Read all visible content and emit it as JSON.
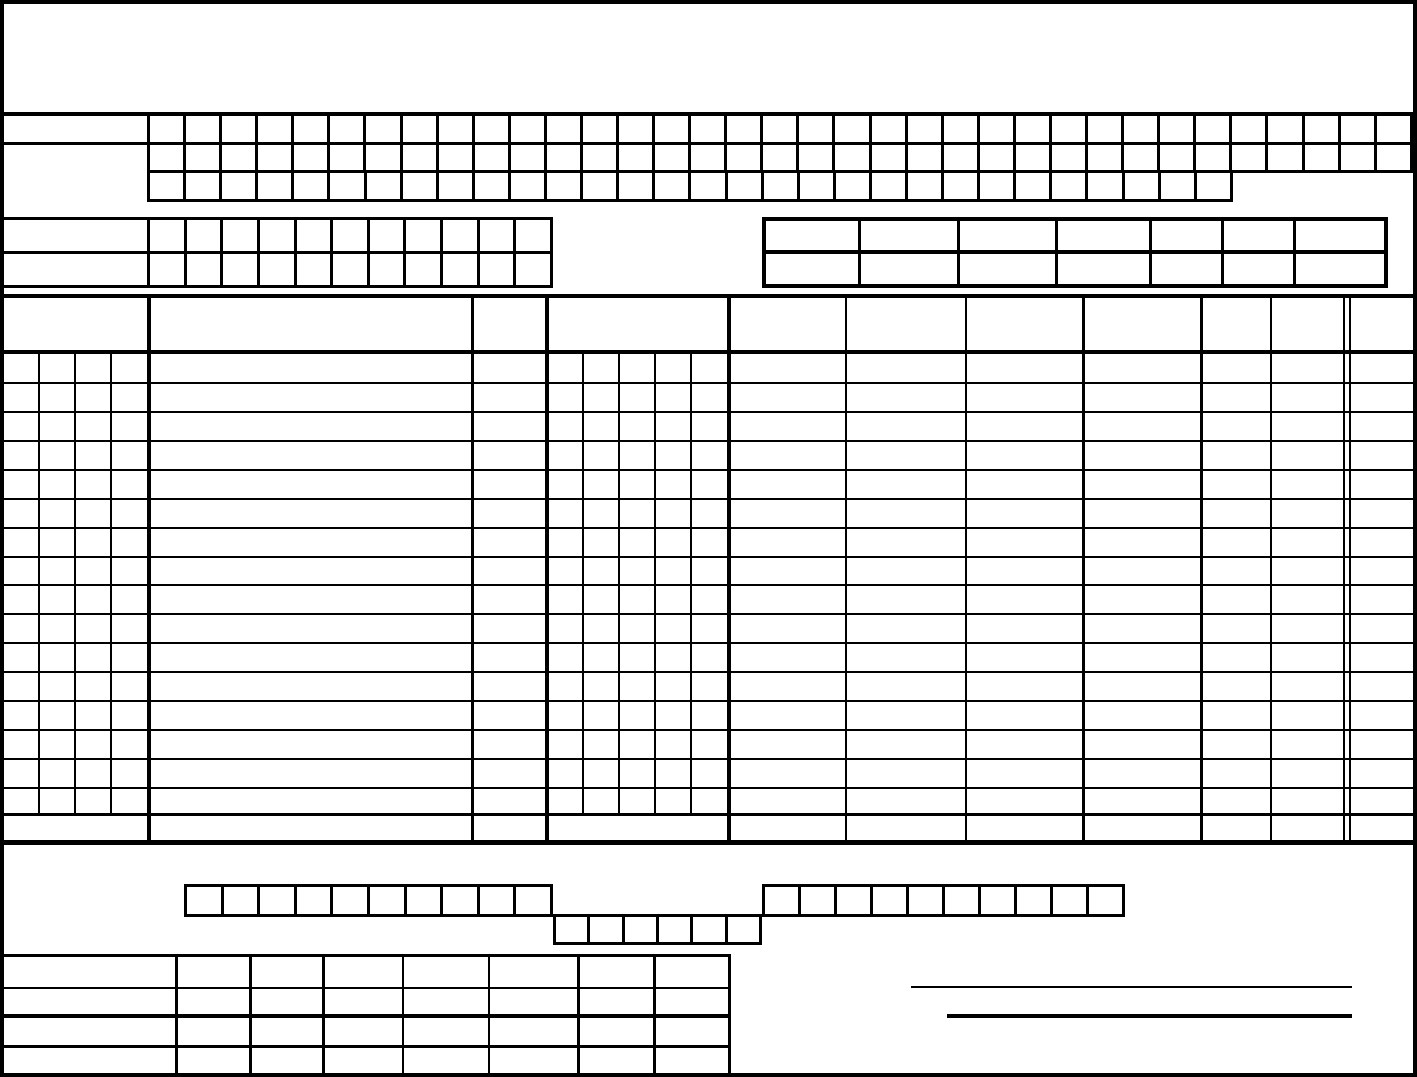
{
  "document": {
    "description": "Blank scanned box-grid form — no printed text or filled values visible",
    "background_color": "#ffffff",
    "line_color": "#000000"
  },
  "box_grids": [
    {
      "id": "top-grid-row-1",
      "cells": 35
    },
    {
      "id": "top-grid-row-2",
      "cells": 35
    },
    {
      "id": "top-grid-row-3",
      "cells": 30
    },
    {
      "id": "mid-grid-row-1",
      "cells": 11
    },
    {
      "id": "mid-grid-row-2",
      "cells": 11
    },
    {
      "id": "bottom-grid-row-a",
      "cells": 10
    },
    {
      "id": "bottom-grid-row-b",
      "cells": 6
    },
    {
      "id": "bottom-grid-row-c",
      "cells": 10
    }
  ],
  "top_right_table": {
    "rows": 2,
    "columns": 7,
    "row_heights": [
      31,
      32
    ],
    "col_widths": [
      96,
      100,
      99,
      95,
      72,
      72,
      92
    ],
    "row_border_tops": [
      0,
      4
    ],
    "col_border_lefts": [
      0,
      3,
      3,
      3,
      3,
      3,
      3
    ]
  },
  "bottom_left_table": {
    "rows": 4,
    "columns": 8,
    "row_heights": [
      32,
      28,
      29,
      27
    ],
    "col_widths": [
      179,
      73,
      72,
      79,
      86,
      89,
      75,
      74
    ],
    "row_border_tops": [
      0,
      2,
      4,
      3
    ],
    "col_border_lefts": [
      0,
      3,
      3,
      3,
      2,
      2,
      3,
      3
    ]
  },
  "main_table": {
    "header_rows": 1,
    "data_rows": 16,
    "total_rows": 1,
    "left_subcolumns": 4,
    "mid_subcolumns": 5,
    "right_columns": 7
  },
  "signature_lines": [
    {
      "id": "signature-line-1",
      "x": 911,
      "y": 986,
      "width": 441,
      "thickness": 2
    },
    {
      "id": "signature-line-2",
      "x": 947,
      "y": 1014,
      "width": 405,
      "thickness": 4
    }
  ],
  "lines": {
    "hlines": [
      [
        0,
        112,
        1417,
        4
      ],
      [
        0,
        142,
        150,
        3
      ],
      [
        0,
        217,
        152,
        3
      ],
      [
        0,
        251,
        150,
        3
      ],
      [
        0,
        285,
        150,
        3
      ],
      [
        0,
        294,
        1417,
        4
      ],
      [
        0,
        350,
        1413,
        4
      ],
      [
        0,
        382,
        1413,
        2
      ],
      [
        0,
        411,
        1413,
        2
      ],
      [
        0,
        440,
        1413,
        2
      ],
      [
        0,
        469,
        1413,
        2
      ],
      [
        0,
        498,
        1413,
        2
      ],
      [
        0,
        527,
        1413,
        2
      ],
      [
        0,
        556,
        1413,
        2
      ],
      [
        0,
        584,
        1413,
        2
      ],
      [
        0,
        613,
        1413,
        2
      ],
      [
        0,
        642,
        1413,
        2
      ],
      [
        0,
        671,
        1413,
        2
      ],
      [
        0,
        700,
        1413,
        2
      ],
      [
        0,
        729,
        1413,
        2
      ],
      [
        0,
        758,
        1413,
        2
      ],
      [
        0,
        787,
        1413,
        2
      ],
      [
        0,
        813,
        1413,
        3
      ],
      [
        0,
        840,
        1417,
        5
      ]
    ],
    "vlines": [
      [
        38,
        350,
        465,
        2
      ],
      [
        74,
        350,
        465,
        2
      ],
      [
        110,
        350,
        465,
        2
      ],
      [
        147,
        294,
        549,
        4
      ],
      [
        471,
        294,
        549,
        3
      ],
      [
        545,
        294,
        549,
        4
      ],
      [
        582,
        350,
        465,
        2
      ],
      [
        618,
        350,
        465,
        2
      ],
      [
        654,
        350,
        465,
        2
      ],
      [
        690,
        350,
        465,
        2
      ],
      [
        727,
        294,
        549,
        4
      ],
      [
        845,
        294,
        549,
        2
      ],
      [
        965,
        294,
        549,
        2
      ],
      [
        1082,
        294,
        549,
        3
      ],
      [
        1200,
        294,
        549,
        3
      ],
      [
        1270,
        294,
        549,
        2
      ],
      [
        1343,
        294,
        549,
        2
      ],
      [
        1349,
        294,
        549,
        2
      ]
    ]
  }
}
